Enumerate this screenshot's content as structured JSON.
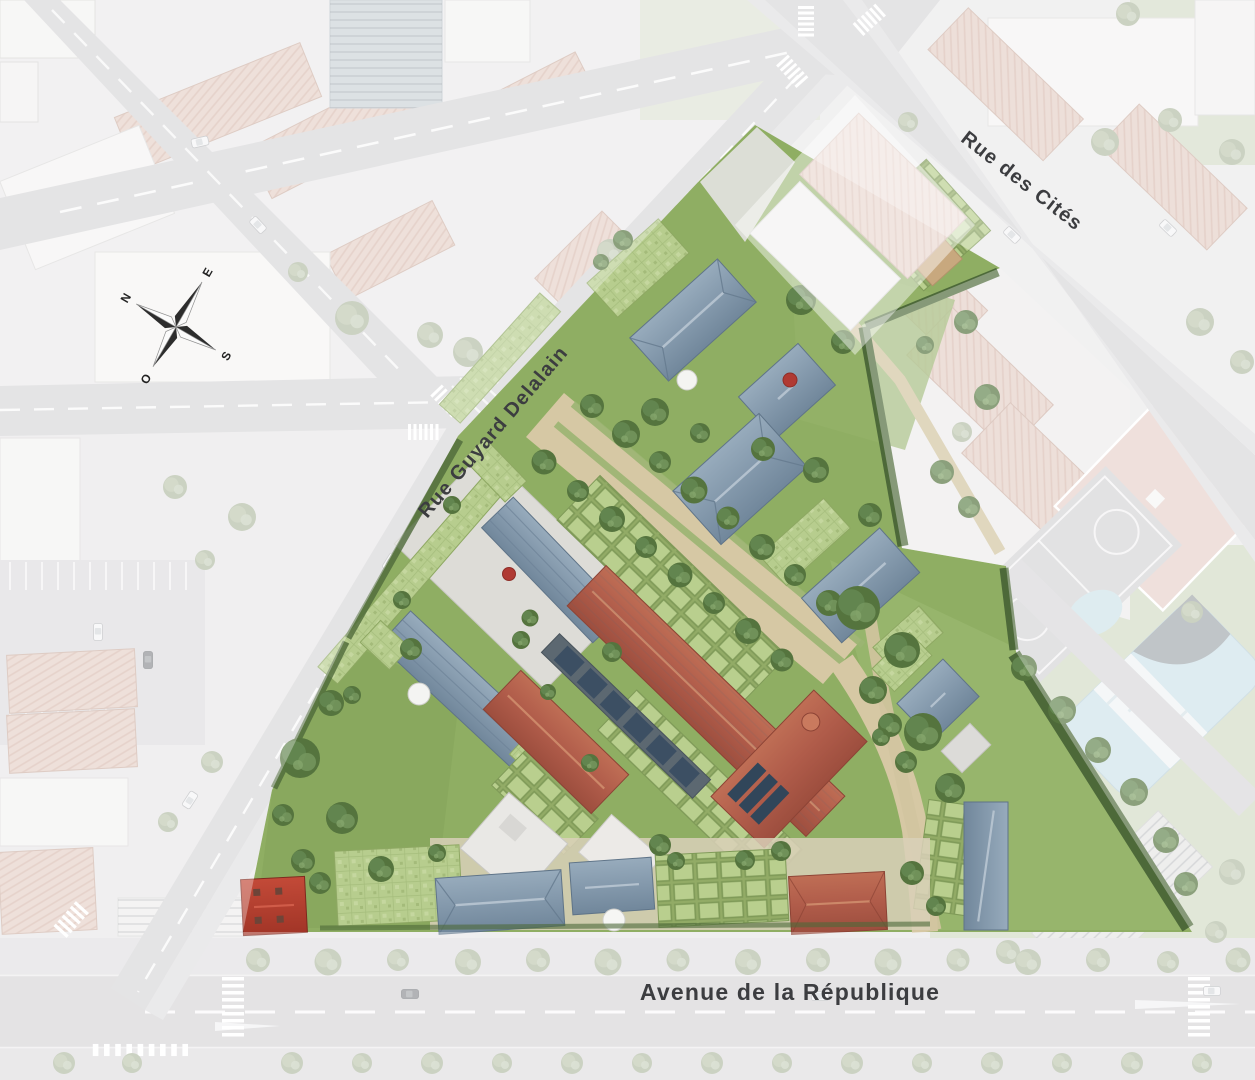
{
  "map": {
    "type": "residential-masterplan-aerial-view",
    "streets": {
      "rue_des_cites": {
        "name": "Rue des Cités"
      },
      "rue_guyard_delalain": {
        "name": "Rue Guyard Delalain"
      },
      "avenue_de_la_republique": {
        "name": "Avenue de la République"
      }
    },
    "compass": {
      "north": "N",
      "east": "E",
      "south": "S",
      "west": "O"
    },
    "palette": {
      "site_lawn": "#8fae63",
      "green_roof": "#b7cd8e",
      "path_beige": "#d6c8a4",
      "roof_blue_gray": "#8499ac",
      "roof_terracotta": "#b05c4a",
      "roof_red_house": "#b43b2e",
      "faded_pink_roof": "#e5d0c7",
      "road_gray": "#d7d6d8",
      "sidewalk_gray": "#e2e1e3",
      "faded_building": "#f2f1f0",
      "faded_lawn": "#d3dcc6",
      "pool_blue": "#cfe3eb",
      "tree_green": "#55743e",
      "label_text": "#3c3d40"
    }
  }
}
